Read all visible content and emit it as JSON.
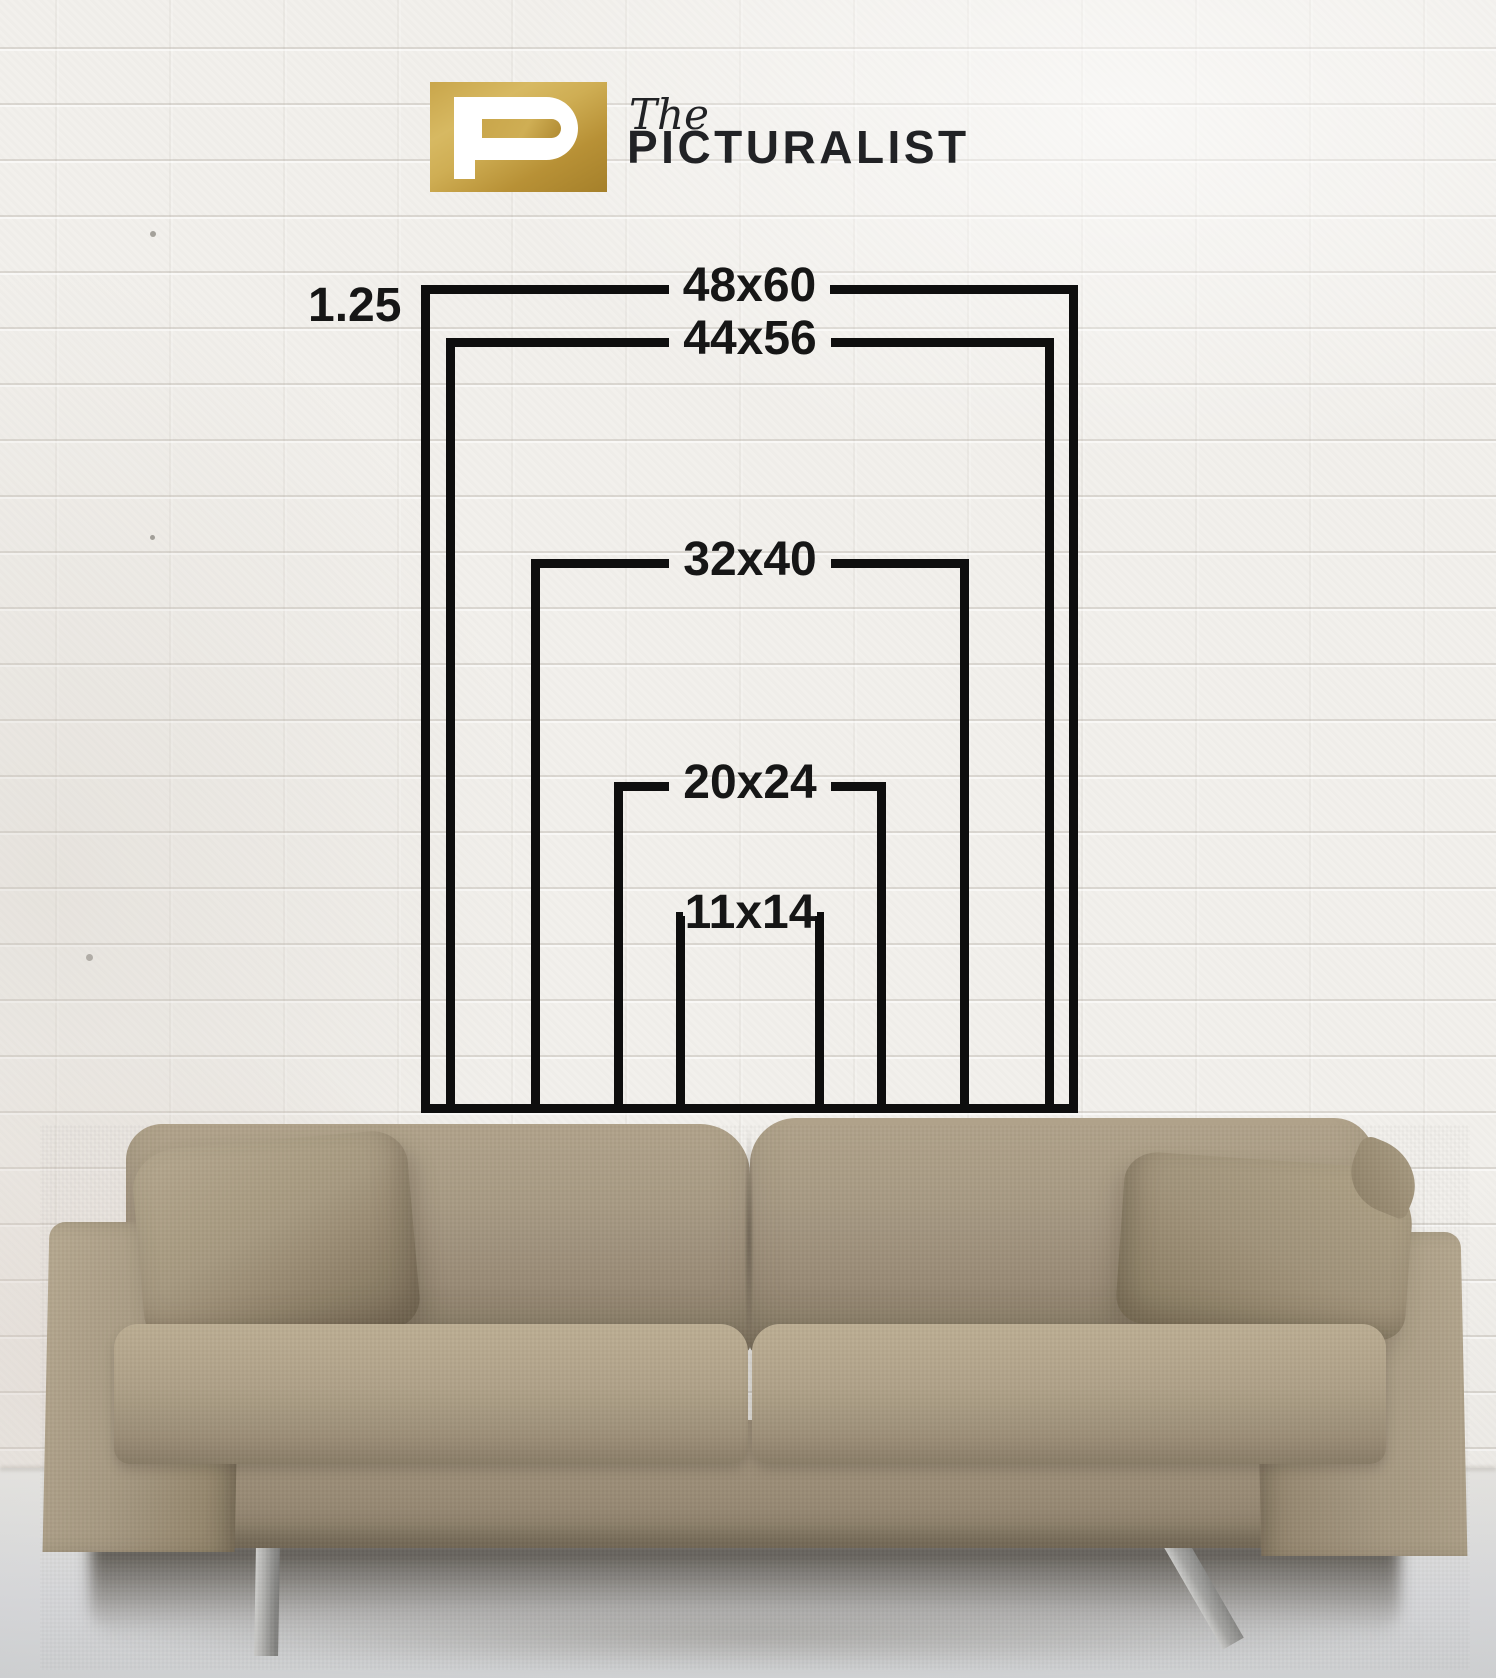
{
  "brand": {
    "mark_letter": "P",
    "prefix": "The",
    "name": "PICTURALIST"
  },
  "size_chart": {
    "moulding_width_label": "1.25",
    "sizes": [
      {
        "label": "48x60",
        "width_in": 48,
        "height_in": 60
      },
      {
        "label": "44x56",
        "width_in": 44,
        "height_in": 56
      },
      {
        "label": "32x40",
        "width_in": 32,
        "height_in": 40
      },
      {
        "label": "20x24",
        "width_in": 20,
        "height_in": 24
      },
      {
        "label": "11x14",
        "width_in": 11,
        "height_in": 14
      }
    ]
  },
  "colors": {
    "line_black": "#0e0e0e",
    "label_black": "#161616",
    "logo_gold_light": "#d7b962",
    "logo_gold_dark": "#a5802a",
    "logo_text": "#212225",
    "wall_white": "#f2f0ec",
    "sofa_taupe": "#a2947e",
    "floor_gray": "#dedfe1"
  }
}
